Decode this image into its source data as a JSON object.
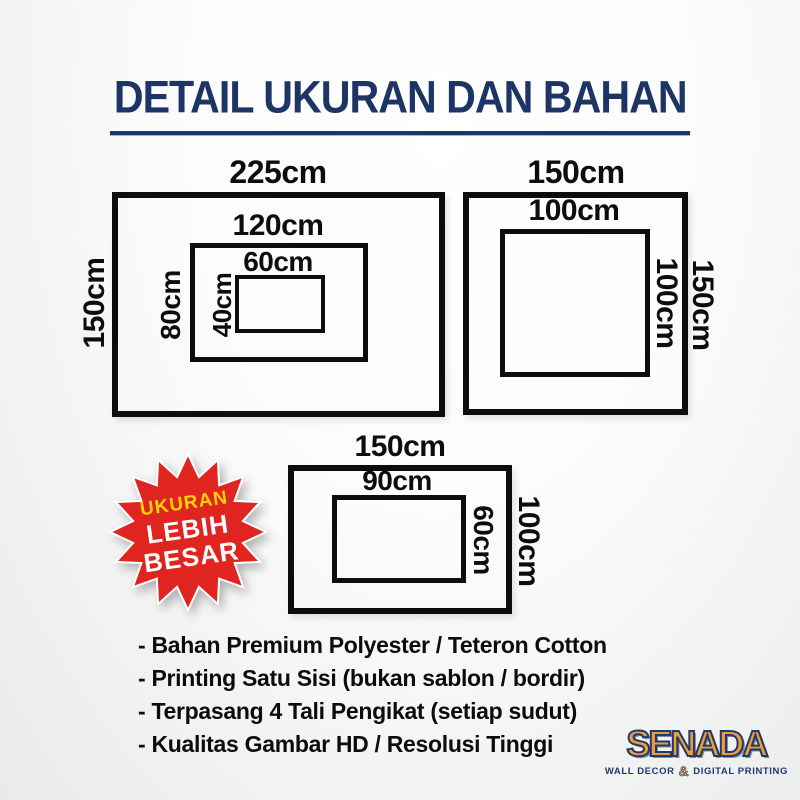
{
  "title": "DETAIL UKURAN DAN BAHAN",
  "size_groups": [
    {
      "name": "nested-left",
      "outer_w": "225cm",
      "outer_h": "150cm",
      "mid_w": "120cm",
      "mid_h": "80cm",
      "inner_w": "60cm",
      "inner_h": "40cm"
    },
    {
      "name": "square-right",
      "outer_w": "150cm",
      "outer_h": "150cm",
      "inner_w": "100cm",
      "inner_h": "100cm"
    },
    {
      "name": "bottom-center",
      "outer_w": "150cm",
      "outer_h": "100cm",
      "inner_w": "90cm",
      "inner_h": "60cm"
    }
  ],
  "badge": {
    "line1": "UKURAN",
    "line2": "LEBIH",
    "line3": "BESAR"
  },
  "features": [
    "- Bahan Premium Polyester / Teteron Cotton",
    "- Printing Satu Sisi (bukan sablon / bordir)",
    "- Terpasang 4 Tali Pengikat (setiap sudut)",
    "- Kualitas Gambar HD / Resolusi Tinggi"
  ],
  "logo": {
    "name": "SENADA",
    "tagline_left": "WALL DECOR",
    "amp": "&",
    "tagline_right": "DIGITAL PRINTING"
  },
  "colors": {
    "title_navy": "#1c3566",
    "ink_black": "#0d0d0d",
    "badge_red": "#e0241f",
    "badge_yellow": "#ffd400",
    "badge_white": "#ffffff",
    "logo_orange": "#f39b2d",
    "logo_navy": "#1e3a70"
  }
}
